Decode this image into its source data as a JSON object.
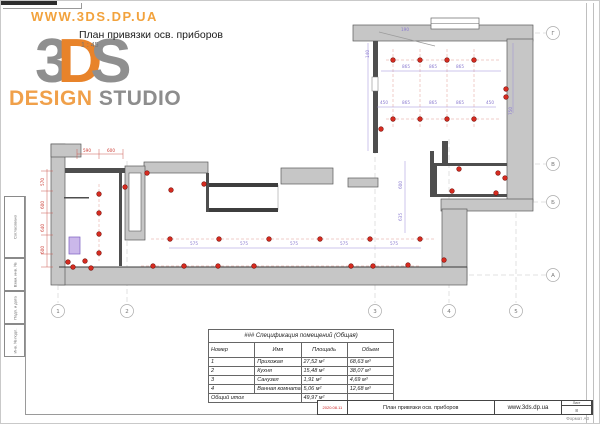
{
  "branding": {
    "watermark": "WWW.3DS.DP.UA",
    "logo": {
      "char3": "3",
      "charD": "D",
      "charS": "S",
      "design": "DESIGN",
      "studio": "STUDIO"
    },
    "title": "План привязки осв. приборов",
    "scale": "1 : 45"
  },
  "stamp": {
    "labels": [
      "Согласовано",
      "Взам. инв. №",
      "Подп. и дата",
      "Инв. № подл."
    ]
  },
  "grid": {
    "cols": [
      {
        "label": "1",
        "x": 57
      },
      {
        "label": "2",
        "x": 126
      },
      {
        "label": "3",
        "x": 374
      },
      {
        "label": "4",
        "x": 448
      },
      {
        "label": "5",
        "x": 515
      }
    ],
    "cols_bubble_y": 310,
    "rows": [
      {
        "label": "Г",
        "y": 32
      },
      {
        "label": "В",
        "y": 163
      },
      {
        "label": "Б",
        "y": 201
      },
      {
        "label": "А",
        "y": 274
      }
    ],
    "rows_bubble_x": 552
  },
  "plan": {
    "colors": {
      "fixture": "#d62b20",
      "fixture_stroke": "#7a120c",
      "dim_red": "#cc3b33",
      "dim_purple": "#8a7ad0"
    },
    "fixtures": [
      {
        "x": 392,
        "y": 59
      },
      {
        "x": 419,
        "y": 59
      },
      {
        "x": 446,
        "y": 59
      },
      {
        "x": 473,
        "y": 59
      },
      {
        "x": 392,
        "y": 118
      },
      {
        "x": 419,
        "y": 118
      },
      {
        "x": 446,
        "y": 118
      },
      {
        "x": 473,
        "y": 118
      },
      {
        "x": 505,
        "y": 88
      },
      {
        "x": 505,
        "y": 96
      },
      {
        "x": 380,
        "y": 128
      },
      {
        "x": 458,
        "y": 168
      },
      {
        "x": 497,
        "y": 172
      },
      {
        "x": 504,
        "y": 177
      },
      {
        "x": 451,
        "y": 190
      },
      {
        "x": 495,
        "y": 192
      },
      {
        "x": 169,
        "y": 238
      },
      {
        "x": 218,
        "y": 238
      },
      {
        "x": 268,
        "y": 238
      },
      {
        "x": 319,
        "y": 238
      },
      {
        "x": 369,
        "y": 238
      },
      {
        "x": 419,
        "y": 238
      },
      {
        "x": 152,
        "y": 265
      },
      {
        "x": 183,
        "y": 265
      },
      {
        "x": 217,
        "y": 265
      },
      {
        "x": 253,
        "y": 265
      },
      {
        "x": 350,
        "y": 265
      },
      {
        "x": 372,
        "y": 265
      },
      {
        "x": 407,
        "y": 264
      },
      {
        "x": 443,
        "y": 259
      },
      {
        "x": 98,
        "y": 193
      },
      {
        "x": 98,
        "y": 212
      },
      {
        "x": 98,
        "y": 233
      },
      {
        "x": 98,
        "y": 252
      },
      {
        "x": 67,
        "y": 261
      },
      {
        "x": 72,
        "y": 266
      },
      {
        "x": 84,
        "y": 260
      },
      {
        "x": 90,
        "y": 267
      },
      {
        "x": 146,
        "y": 172
      },
      {
        "x": 203,
        "y": 183
      },
      {
        "x": 124,
        "y": 186
      },
      {
        "x": 170,
        "y": 189
      }
    ],
    "dim_labels": [
      {
        "t": "590",
        "x": 86,
        "y": 151,
        "c": "r"
      },
      {
        "t": "600",
        "x": 110,
        "y": 151,
        "c": "r"
      },
      {
        "t": "570",
        "x": 43,
        "y": 181,
        "c": "r",
        "rot": 1
      },
      {
        "t": "600",
        "x": 43,
        "y": 204,
        "c": "r",
        "rot": 1
      },
      {
        "t": "640",
        "x": 43,
        "y": 227,
        "c": "r",
        "rot": 1
      },
      {
        "t": "600",
        "x": 43,
        "y": 249,
        "c": "r",
        "rot": 1
      },
      {
        "t": "865",
        "x": 405,
        "y": 67,
        "c": "p"
      },
      {
        "t": "865",
        "x": 432,
        "y": 67,
        "c": "p"
      },
      {
        "t": "865",
        "x": 459,
        "y": 67,
        "c": "p"
      },
      {
        "t": "450",
        "x": 383,
        "y": 103,
        "c": "p"
      },
      {
        "t": "865",
        "x": 405,
        "y": 103,
        "c": "p"
      },
      {
        "t": "865",
        "x": 432,
        "y": 103,
        "c": "p"
      },
      {
        "t": "865",
        "x": 459,
        "y": 103,
        "c": "p"
      },
      {
        "t": "450",
        "x": 489,
        "y": 103,
        "c": "p"
      },
      {
        "t": "575",
        "x": 193,
        "y": 244,
        "c": "p"
      },
      {
        "t": "575",
        "x": 243,
        "y": 244,
        "c": "p"
      },
      {
        "t": "575",
        "x": 293,
        "y": 244,
        "c": "p"
      },
      {
        "t": "575",
        "x": 343,
        "y": 244,
        "c": "p"
      },
      {
        "t": "575",
        "x": 393,
        "y": 244,
        "c": "p"
      },
      {
        "t": "600",
        "x": 401,
        "y": 184,
        "c": "p",
        "rot": 1
      },
      {
        "t": "635",
        "x": 401,
        "y": 216,
        "c": "p",
        "rot": 1
      },
      {
        "t": "140",
        "x": 368,
        "y": 53,
        "c": "p",
        "rot": 1
      },
      {
        "t": "190",
        "x": 404,
        "y": 30,
        "c": "p"
      },
      {
        "t": "750",
        "x": 511,
        "y": 110,
        "c": "p",
        "rot": 1
      }
    ]
  },
  "spec_table": {
    "title": "### Спецификация помещений (Общая)",
    "headers": [
      "Номер",
      "Имя",
      "Площадь",
      "Объем"
    ],
    "rows": [
      [
        "1",
        "Прихожая",
        "27,52 м²",
        "68,63 м³"
      ],
      [
        "2",
        "Кухня",
        "15,48 м²",
        "38,07 м³"
      ],
      [
        "3",
        "Санузел",
        "1,91 м²",
        "4,69 м³"
      ],
      [
        "4",
        "Ванная комната",
        "5,06 м²",
        "12,68 м³"
      ]
    ],
    "total_label": "Общий итог",
    "total_area": "49,97 м²"
  },
  "titleblock": {
    "date": "2020.08.11",
    "doc_title": "План привязки осв. приборов",
    "site": "www.3ds.dp.ua",
    "sheet_label": "Лист",
    "sheet_no": "8",
    "format_note": "Формат А3"
  }
}
